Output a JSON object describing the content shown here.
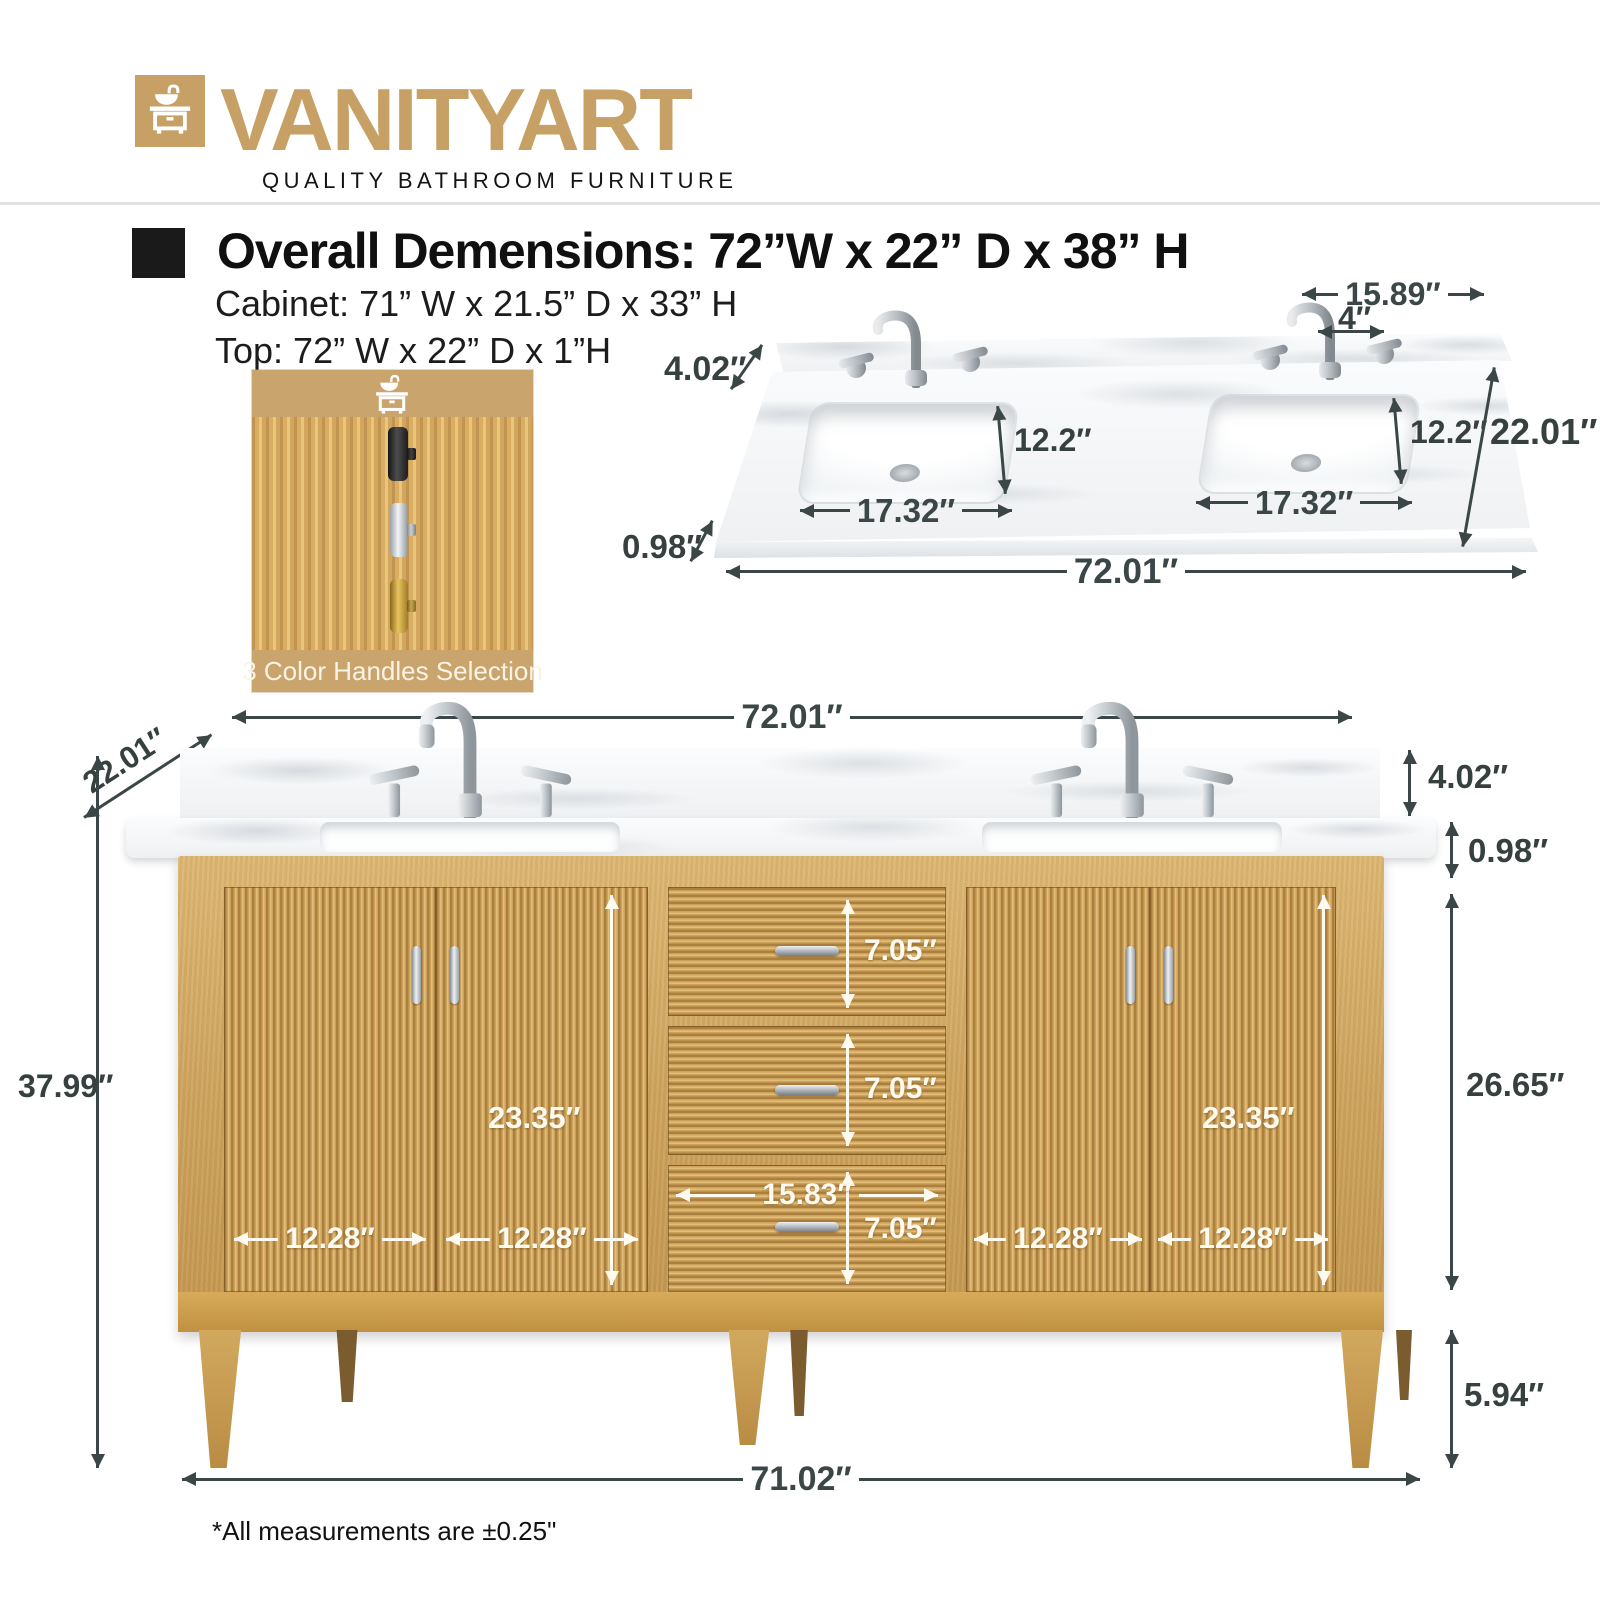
{
  "brand": {
    "wordmark": "VANITYART",
    "tagline": "QUALITY BATHROOM FURNITURE",
    "accent_color": "#c7a066",
    "icon": "vanity-sink-icon"
  },
  "specs": {
    "heading": "Overall Demensions: 72”W x 22” D x 38” H",
    "cabinet_line": "Cabinet: 71” W x 21.5” D x 33” H",
    "top_line": "Top: 72” W x 22” D x 1”H"
  },
  "handles_inset": {
    "caption": "3 Color Handles Selection",
    "options": [
      {
        "name": "black-handle",
        "color": "#2e2a28"
      },
      {
        "name": "chrome-handle",
        "color": "#c9ccd0"
      },
      {
        "name": "gold-handle",
        "color": "#c99f3f"
      }
    ]
  },
  "countertop_view": {
    "backsplash_height": "4.02″",
    "right_inset_width": "15.89″",
    "faucet_spread": "4″",
    "left_sink_depth": "12.2″",
    "right_sink_depth": "12.2″",
    "overall_depth": "22.01″",
    "left_sink_width": "17.32″",
    "right_sink_width": "17.32″",
    "top_thickness": "0.98″",
    "overall_width": "72.01″"
  },
  "front_view": {
    "overall_width": "72.01″",
    "overall_depth": "22.01″",
    "overall_height": "37.99″",
    "backsplash_height": "4.02″",
    "top_thickness": "0.98″",
    "cabinet_height": "26.65″",
    "left_door_height": "23.35″",
    "right_door_height": "23.35″",
    "door_widths": [
      "12.28″",
      "12.28″",
      "12.28″",
      "12.28″"
    ],
    "drawer_heights": [
      "7.05″",
      "7.05″",
      "7.05″"
    ],
    "drawer_width": "15.83″",
    "leg_height": "5.94″",
    "cabinet_width": "71.02″"
  },
  "footnote": "*All measurements are ±0.25\""
}
